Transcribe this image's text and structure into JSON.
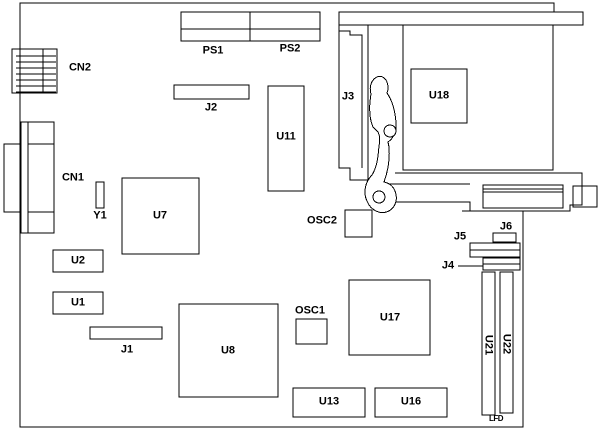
{
  "diagram": {
    "kind": "pcb-component-layout",
    "background_color": "#ffffff",
    "line_color": "#000000"
  },
  "labels": {
    "cn2": "CN2",
    "cn1": "CN1",
    "y1": "Y1",
    "u7": "U7",
    "u2": "U2",
    "u1": "U1",
    "j1": "J1",
    "u8": "U8",
    "j2": "J2",
    "u11": "U11",
    "ps1": "PS1",
    "ps2": "PS2",
    "j3": "J3",
    "u18": "U18",
    "osc2": "OSC2",
    "osc1": "OSC1",
    "u17": "U17",
    "u13": "U13",
    "u16": "U16",
    "j4": "J4",
    "j5": "J5",
    "j6": "J6",
    "u21": "U21",
    "u22": "U22",
    "lfd": "LFD"
  }
}
